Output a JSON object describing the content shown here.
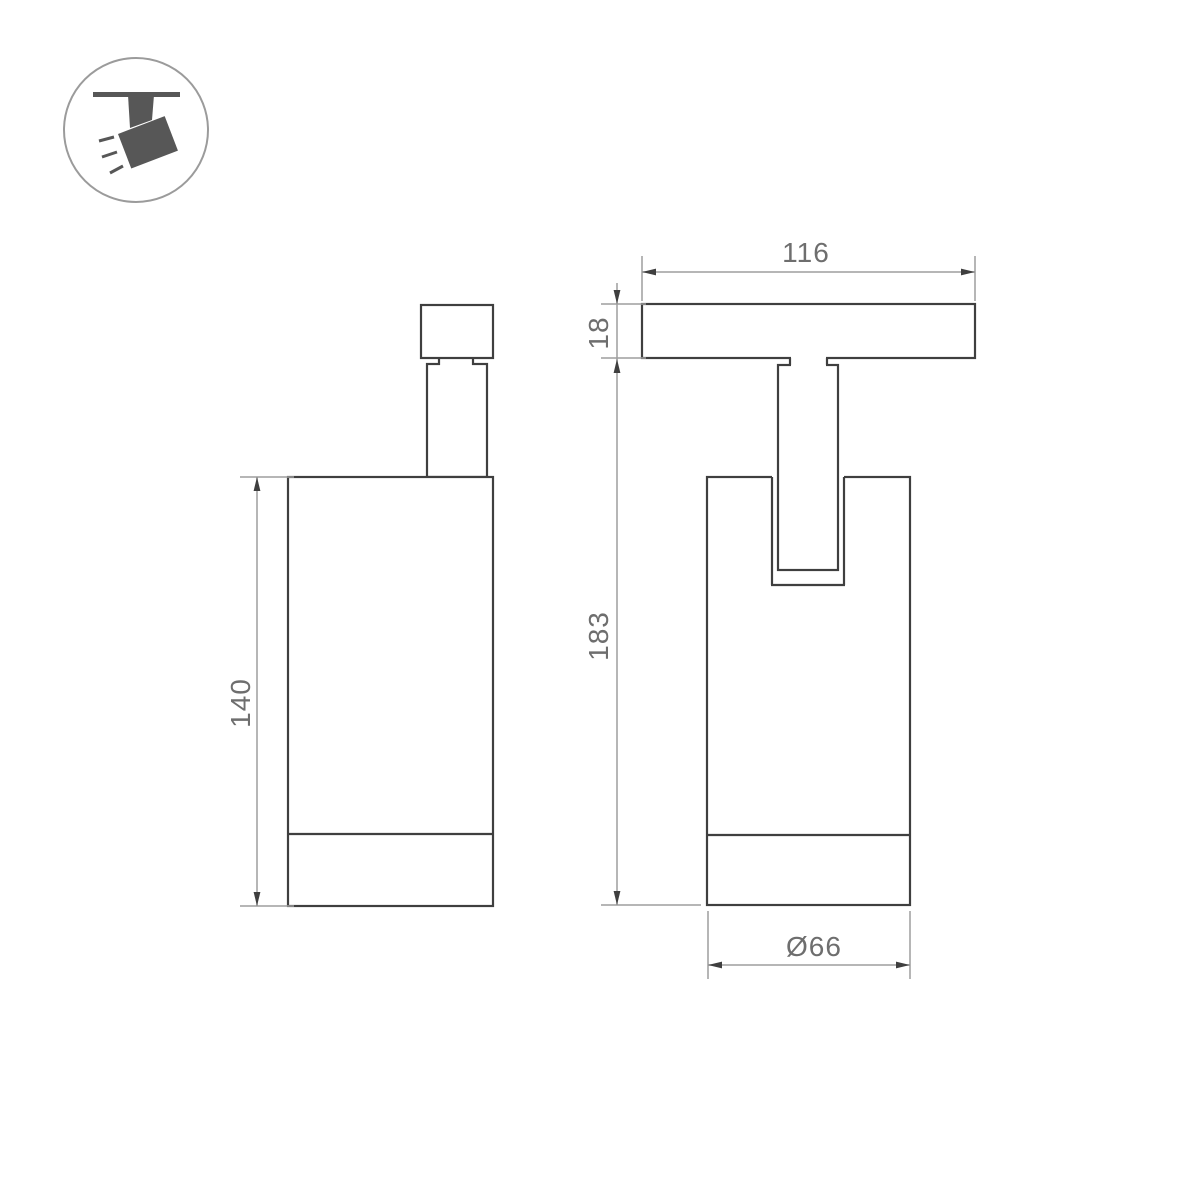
{
  "page": {
    "type": "product-dimension-drawing",
    "background": "#ffffff"
  },
  "icon": {
    "name": "ceiling-track-spotlight"
  },
  "dimensions": {
    "side_body_height": "140",
    "track_plate_width": "116",
    "track_plate_thickness": "18",
    "overall_drop_height": "183",
    "body_diameter": "Ø66"
  },
  "colors": {
    "outline": "#3f3f3f",
    "dimension_line": "#9e9e9e",
    "dimension_text": "#6e6e6e",
    "icon_fill": "#575757",
    "icon_circle": "#9b9b9b"
  }
}
